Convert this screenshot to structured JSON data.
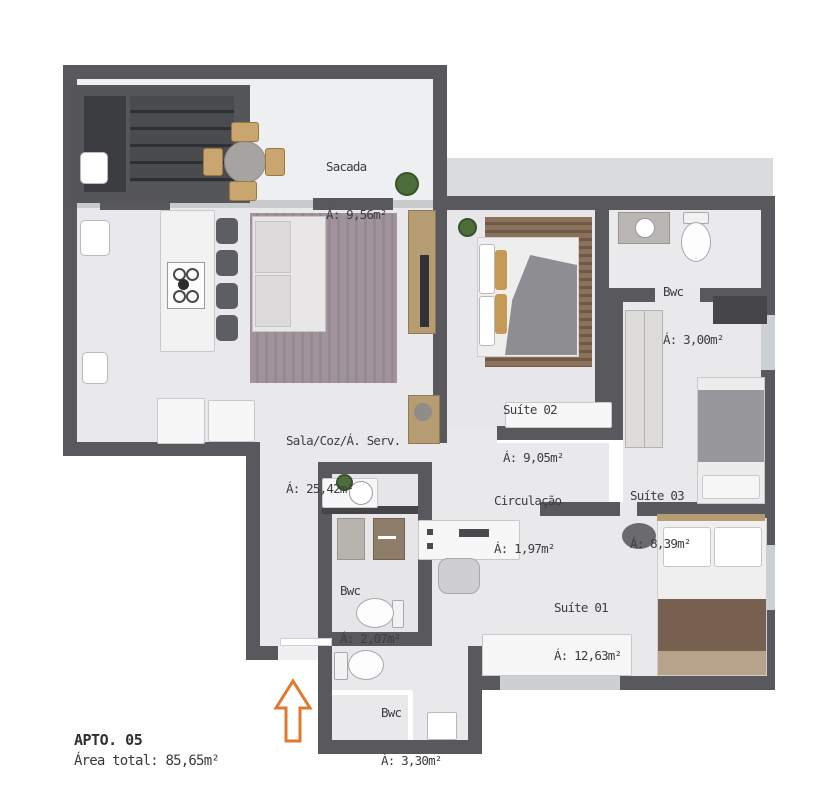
{
  "floorplan": {
    "apartment": {
      "title": "APTO. 05",
      "total_area_label": "Área total: 85,65m²"
    },
    "rooms": {
      "sacada": {
        "name": "Sacada",
        "area": "Á: 9,56m²"
      },
      "sala": {
        "name": "Sala/Coz/Á. Serv.",
        "area": "Á: 25,42m²"
      },
      "suite02": {
        "name": "Suíte 02",
        "area": "Á: 9,05m²"
      },
      "bwc_suite02": {
        "name": "Bwc",
        "area": "Á: 3,00m²"
      },
      "suite03": {
        "name": "Suíte 03",
        "area": "Á: 8,39m²"
      },
      "circulacao": {
        "name": "Circulação",
        "area": "Á: 1,97m²"
      },
      "suite01": {
        "name": "Suíte 01",
        "area": "Á: 12,63m²"
      },
      "bwc_social": {
        "name": "Bwc",
        "area": "Á: 2,07m²"
      },
      "bwc_suite01": {
        "name": "Bwc",
        "area": "Á: 3,30m²"
      }
    },
    "colors": {
      "wall": "#59595d",
      "floor": "#e9e9eb",
      "arrow": "#e0792f",
      "label": "#3d3d40"
    }
  }
}
